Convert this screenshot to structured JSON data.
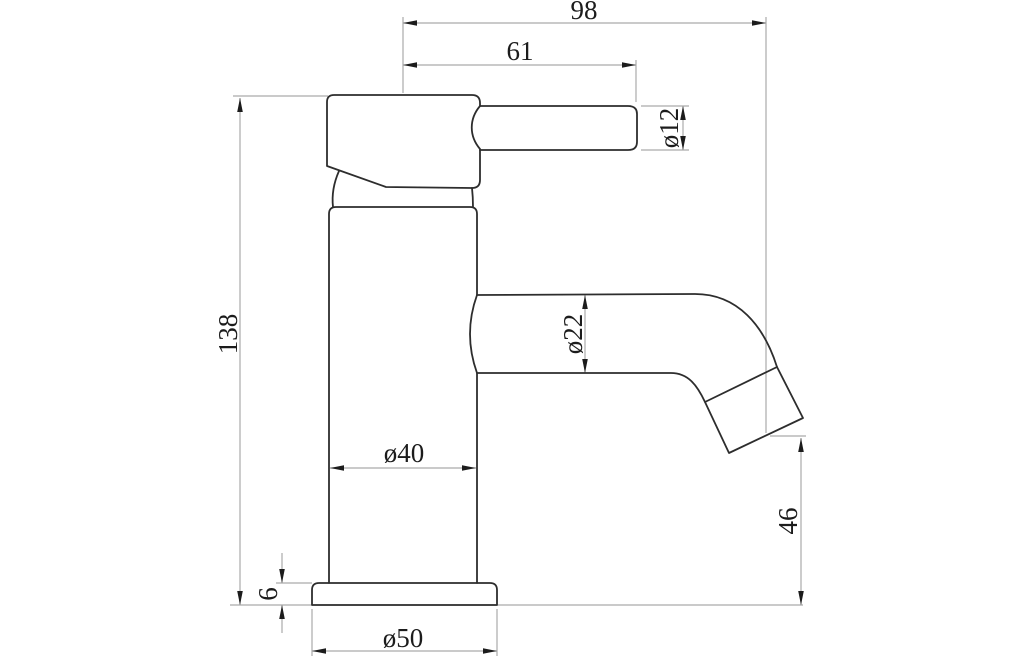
{
  "drawing": {
    "kind": "technical-dimension-drawing",
    "subject": "single-lever basin mixer tap, side elevation",
    "units": "mm",
    "background_color": "#ffffff",
    "outline_color": "#2d2d2d",
    "dimension_line_color": "#ababab",
    "text_color": "#1c1c1c",
    "dimensions": {
      "overall_reach": {
        "label": "98"
      },
      "handle_reach": {
        "label": "61"
      },
      "handle_diameter": {
        "label": "ø12"
      },
      "total_height": {
        "label": "138"
      },
      "spout_diameter": {
        "label": "ø22"
      },
      "body_diameter": {
        "label": "ø40"
      },
      "spout_clearance_height": {
        "label": "46"
      },
      "base_height": {
        "label": "6"
      },
      "base_diameter": {
        "label": "ø50"
      }
    }
  }
}
